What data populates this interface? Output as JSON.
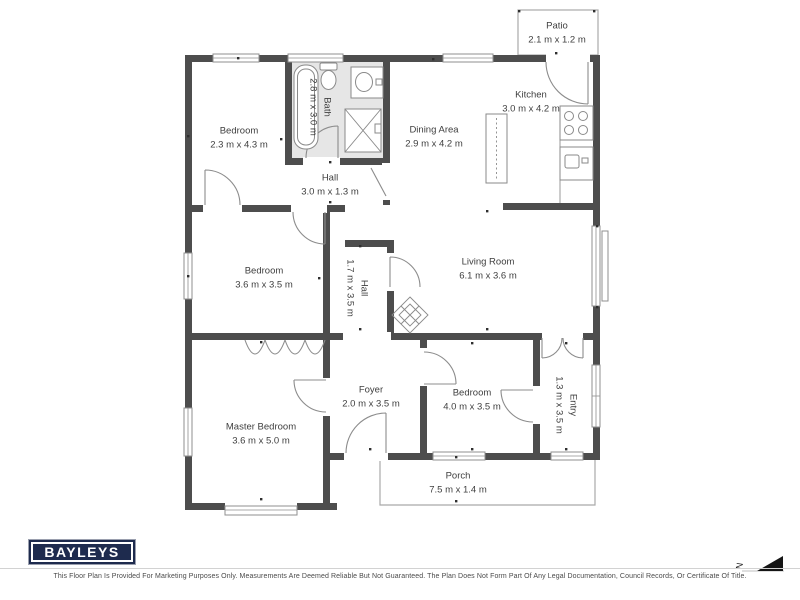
{
  "rooms": {
    "patio": {
      "name": "Patio",
      "dims": "2.1 m x 1.2 m"
    },
    "kitchen": {
      "name": "Kitchen",
      "dims": "3.0 m x 4.2 m"
    },
    "dining": {
      "name": "Dining Area",
      "dims": "2.9 m x 4.2 m"
    },
    "bath": {
      "name": "Bath",
      "dims": "2.8 m x 3.0 m"
    },
    "hall_upper": {
      "name": "Hall",
      "dims": "3.0 m x 1.3 m"
    },
    "bedroom_top": {
      "name": "Bedroom",
      "dims": "2.3 m x 4.3 m"
    },
    "bedroom_mid": {
      "name": "Bedroom",
      "dims": "3.6 m x 3.5 m"
    },
    "living": {
      "name": "Living Room",
      "dims": "6.1 m x 3.6 m"
    },
    "hall_lower": {
      "name": "Hall",
      "dims": "1.7 m x 3.5 m"
    },
    "foyer": {
      "name": "Foyer",
      "dims": "2.0 m x 3.5 m"
    },
    "bedroom_rear": {
      "name": "Bedroom",
      "dims": "4.0 m x 3.5 m"
    },
    "entry": {
      "name": "Entry",
      "dims": "1.3 m x 3.5 m"
    },
    "master": {
      "name": "Master Bedroom",
      "dims": "3.6 m x 5.0 m"
    },
    "porch": {
      "name": "Porch",
      "dims": "7.5 m x 1.4 m"
    }
  },
  "branding": {
    "logo_text": "BAYLEYS"
  },
  "compass": {
    "label": "N"
  },
  "footer": {
    "disclaimer": "This Floor Plan Is Provided For Marketing Purposes Only. Measurements Are Deemed Reliable But Not Guaranteed. The Plan Does Not Form Part Of Any Legal Documentation, Council Records, Or Certificate Of Title."
  },
  "colors": {
    "wall": "#4d4d4d",
    "bath_fill": "#e6e6e6",
    "logo_bg": "#1e2b4e"
  }
}
